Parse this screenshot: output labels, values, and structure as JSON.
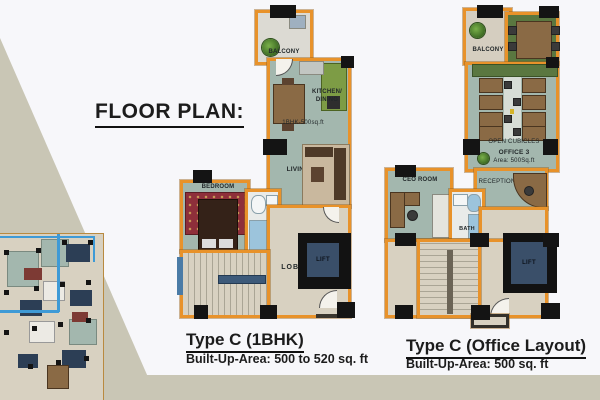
{
  "heading": {
    "title": "FLOOR PLAN:"
  },
  "plan1": {
    "title": "Type C (1BHK)",
    "subtitle": "Built-Up-Area: 500 to 520 sq. ft",
    "labels": {
      "balcony": "BALCONY",
      "kitchen_line1": "KITCHEN/",
      "kitchen_line2": "DINING",
      "unit_area": "1BHK-500sq.ft",
      "living": "LIVING",
      "bedroom": "BEDROOM",
      "lobby": "LOBBY",
      "lift": "LIFT"
    }
  },
  "plan2": {
    "title": "Type C (Office Layout)",
    "subtitle": "Built-Up-Area: 500 sq. ft",
    "labels": {
      "balcony": "BALCONY",
      "open_cubicles": "OPEN CUBICLES",
      "office_name": "OFFICE 3",
      "office_area": "Area: 500Sq.ft",
      "ceo_room": "CEO ROOM",
      "reception": "RECEPTION",
      "bath": "BATH",
      "lift": "LIFT"
    }
  },
  "colors": {
    "bg": "#f7f7fa",
    "band": "#c9c6b5",
    "wall": "#e8922a",
    "floor-teal": "#a3b7ae",
    "floor-beige": "#d8d1c1",
    "floor-gray": "#dcdad3",
    "floor-tan": "#d5cec0",
    "floor-olive": "#5a7740",
    "counter-green": "#7d9c45",
    "lift-navy": "#3a4f69",
    "column-black": "#141414",
    "carpet-red": "#8e2f3a",
    "carpet-beige": "#c9b89e",
    "wood": "#8a6a45",
    "wood-dark": "#5c4330",
    "text-dark": "#1c1c1c"
  }
}
